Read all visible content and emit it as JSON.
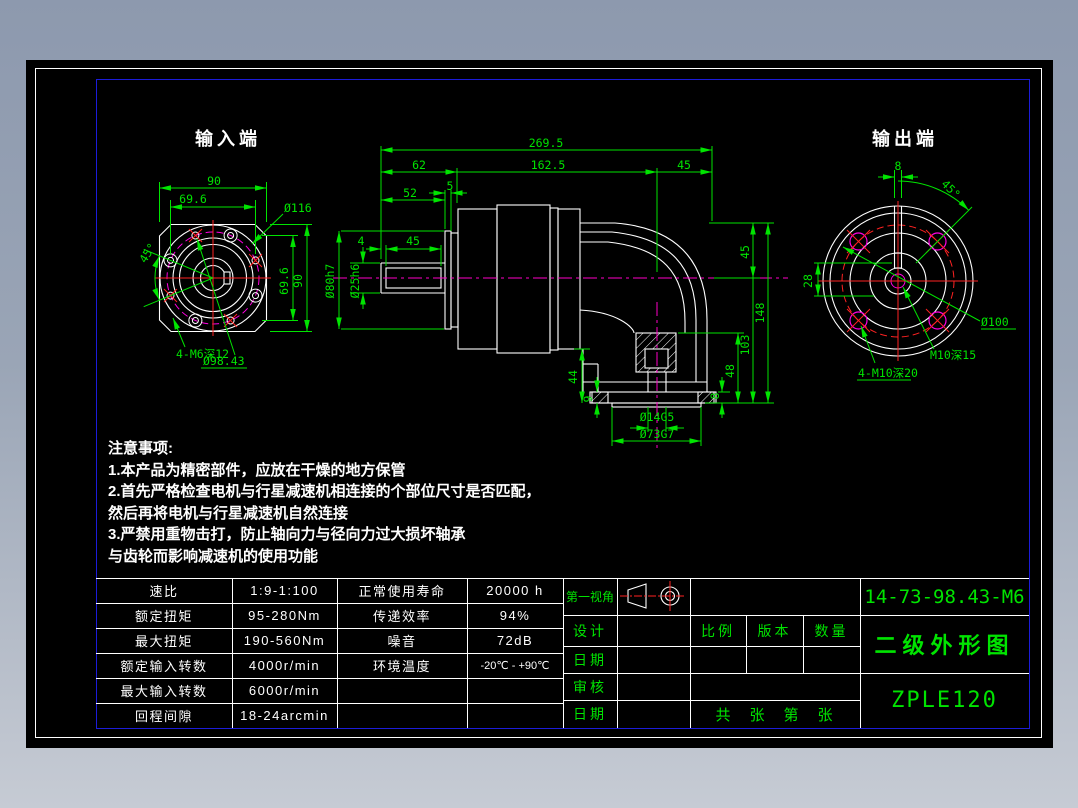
{
  "palette": {
    "green": "#00e400",
    "white": "#ffffff",
    "red": "#ff2222",
    "magenta": "#ff00e0",
    "frame_blue": "#1c1cd8"
  },
  "views": {
    "input": {
      "title": "输入端",
      "dims": {
        "width": "90",
        "inner_width": "69.6",
        "corner_dia": "Ø116",
        "angle": "45°",
        "height": "90",
        "inner_height": "69.6",
        "tap_note": "4-M6深12",
        "bolt_circle": "Ø98.43"
      }
    },
    "side": {
      "dims": {
        "total": "269.5",
        "s62": "62",
        "s162": "162.5",
        "s45": "45",
        "len52": "52",
        "thk5": "5",
        "off4": "4",
        "key45": "45",
        "dia80": "Ø80h7",
        "dia25": "Ø25h6",
        "r45": "45",
        "r148": "148",
        "r103": "103",
        "r48": "48",
        "r8": "8",
        "l44": "44",
        "l9": "9",
        "bore": "Ø14G5",
        "spigot": "Ø73G7"
      }
    },
    "output": {
      "title": "输出端",
      "dims": {
        "key8": "8",
        "angle": "45°",
        "depth28": "28",
        "bolt_circle": "Ø100",
        "center_tap": "M10深15",
        "flange_tap": "4-M10深20"
      }
    }
  },
  "notes": {
    "heading": "注意事项:",
    "line1": "1.本产品为精密部件，应放在干燥的地方保管",
    "line2": "2.首先严格检查电机与行星减速机相连接的个部位尺寸是否匹配，",
    "line3": "然后再将电机与行星减速机自然连接",
    "line4": "3.严禁用重物击打，防止轴向力与径向力过大损坏轴承",
    "line5": "与齿轮而影响减速机的使用功能"
  },
  "spec": {
    "rows": [
      [
        "速比",
        "1:9-1:100",
        "正常使用寿命",
        "20000 h"
      ],
      [
        "额定扭矩",
        "95-280Nm",
        "传递效率",
        "94%"
      ],
      [
        "最大扭矩",
        "190-560Nm",
        "噪音",
        "72dB"
      ],
      [
        "额定输入转数",
        "4000r/min",
        "环境温度",
        "-20℃ - +90℃"
      ],
      [
        "最大输入转数",
        "6000r/min",
        "",
        ""
      ],
      [
        "回程间隙",
        "18-24arcmin",
        "",
        ""
      ]
    ]
  },
  "title_block": {
    "view_label": "第一视角",
    "design": "设计",
    "date1": "日期",
    "audit": "审核",
    "date2": "日期",
    "scale": "比例",
    "version": "版本",
    "qty": "数量",
    "sheets": "共　张　第　张",
    "code": "14-73-98.43-M6",
    "drawing_name": "二级外形图",
    "model": "ZPLE120"
  }
}
